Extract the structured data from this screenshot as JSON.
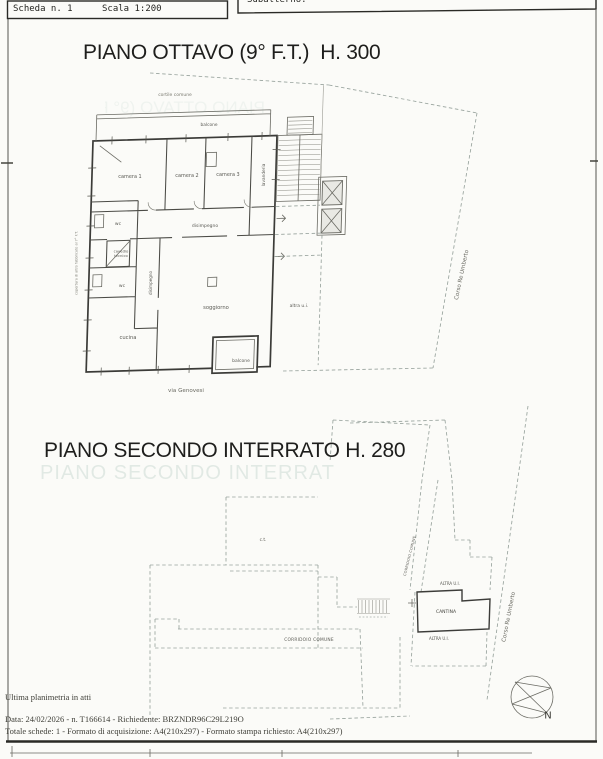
{
  "header": {
    "scheda": "Scheda n. 1",
    "scala": "Scala 1:200",
    "subalterno": "Subalterno:"
  },
  "plan_upper": {
    "title": "PIANO OTTAVO (9° F.T.)  H. 300",
    "rooms": {
      "cortile": "cortile comune",
      "balcone_top": "balcone",
      "camera1": "camera 1",
      "camera2": "camera 2",
      "camera3": "camera 3",
      "lavanderia": "lavanderia",
      "disimpegno": "disimpegno",
      "wc_top": "wc",
      "cavedio": "cavedio\ntecnico",
      "disimpegno_v": "disimpegno",
      "wc_bottom": "wc",
      "soggiorno": "soggiorno",
      "cucina": "cucina",
      "balcone_bottom": "balcone",
      "altra_ui": "altra u.i."
    },
    "streets": {
      "corso": "Corso Re Umberto",
      "via": "via Genovesi"
    },
    "notes": {
      "edge": "copertura di altro fabbricato al 7° F.T."
    }
  },
  "plan_lower": {
    "title": "PIANO SECONDO INTERRATO H. 280",
    "ghost_title": "PIANO SECONDO INTERRATO H. 280",
    "rooms": {
      "ct": "c.t.",
      "corridoio_diag": "CORRIDOIO COMUNE",
      "altra_ui_top": "ALTRA U.I.",
      "cantina": "CANTINA",
      "altra_ui_bottom": "ALTRA U.I.",
      "corridoio": "CORRIDOIO COMUNE"
    },
    "streets": {
      "corso": "Corso Re Umberto"
    },
    "compass": {
      "north": "N"
    }
  },
  "footer": {
    "line1": "Ultima planimetria in atti",
    "line2": "Data: 24/02/2026 - n. T166614 - Richiedente: BRZNDR96C29L219O",
    "line3": "Totale schede: 1 - Formato di acquisizione: A4(210x297) - Formato stampa richiesto: A4(210x297)"
  },
  "colors": {
    "paper": "#fbfbf8",
    "ink": "#1e1e1c",
    "wall": "#3b3b38",
    "dashed": "#98a39d",
    "ghost": "#7fa698"
  }
}
